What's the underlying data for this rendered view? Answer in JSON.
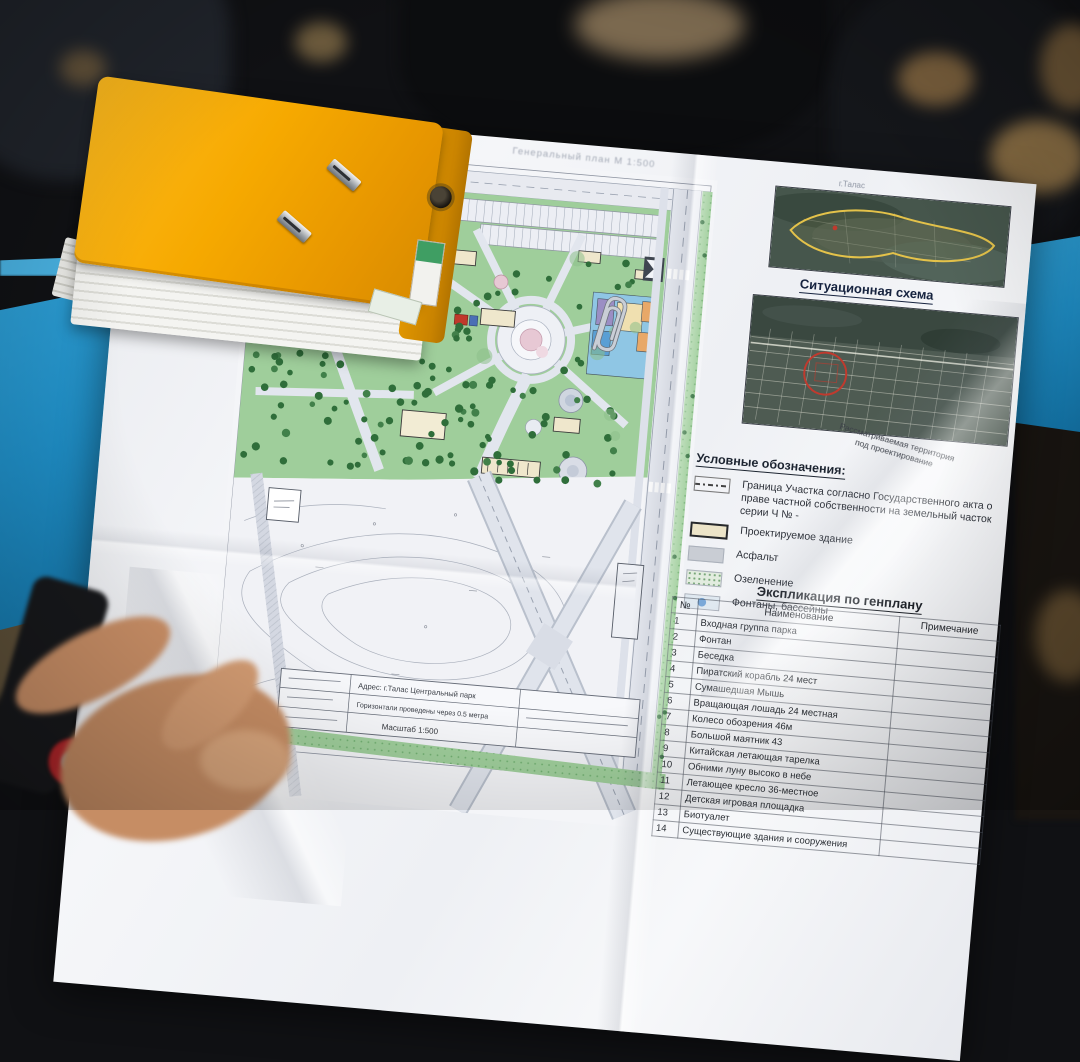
{
  "document": {
    "plan_title": "Генеральный план  М 1:500",
    "city_label": "г.Талас",
    "situational_title": "Ситуационная схема",
    "territory_caption_line1": "Рассматриваемая территория",
    "territory_caption_line2": "под проектирование",
    "legend": {
      "title": "Условные обозначения:",
      "items": [
        {
          "symbol": "boundary",
          "label": "Граница Участка согласно Государственного акта о праве частной собственности на земельный часток серии Ч № -"
        },
        {
          "symbol": "building",
          "label": "Проектируемое здание"
        },
        {
          "symbol": "asphalt",
          "label": "Асфальт"
        },
        {
          "symbol": "green",
          "label": "Озеленение"
        },
        {
          "symbol": "fountain",
          "label": "Фонтаны, бассейны"
        }
      ]
    },
    "table": {
      "title": "Экспликация по генплану",
      "columns": [
        "№",
        "Наименование",
        "Примечание"
      ],
      "rows": [
        [
          "1",
          "Входная группа парка",
          ""
        ],
        [
          "2",
          "Фонтан",
          ""
        ],
        [
          "3",
          "Беседка",
          ""
        ],
        [
          "4",
          "Пиратский корабль 24 мест",
          ""
        ],
        [
          "5",
          "Сумашедшая Мышь",
          ""
        ],
        [
          "6",
          "Вращающая лошадь 24 местная",
          ""
        ],
        [
          "7",
          "Колесо обозрения 46м",
          ""
        ],
        [
          "8",
          "Большой маятник 43",
          ""
        ],
        [
          "9",
          "Китайская летающая тарелка",
          ""
        ],
        [
          "10",
          "Обними луну высоко в небе",
          ""
        ],
        [
          "11",
          "Летающее кресло 36-местное",
          ""
        ],
        [
          "12",
          "Детская игровая площадка",
          ""
        ],
        [
          "13",
          "Биотуалет",
          ""
        ],
        [
          "14",
          "Существующие здания и сооружения",
          ""
        ]
      ]
    },
    "titleblock": {
      "row1": "Адрес: г.Талас Центральный парк",
      "row2": "Горизонтали проведены через 0.5 метра",
      "row3": "Масштаб 1:500"
    }
  },
  "colors": {
    "table_blue": "#1f8ec6",
    "binder_yellow": "#f6a900",
    "park_green": "#9fce9b",
    "boundary_yellow": "#e4c24a",
    "marker_red": "#c03a2e"
  }
}
